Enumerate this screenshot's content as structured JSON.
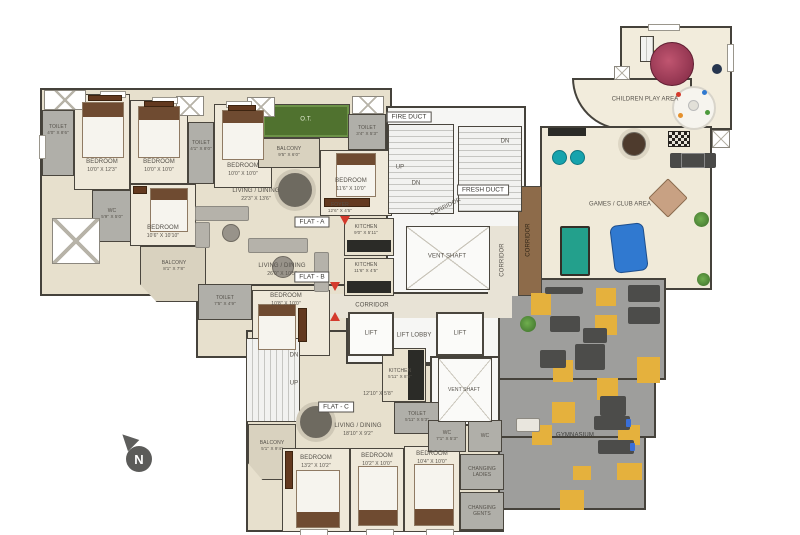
{
  "plan_title": "Residential Floor Plan with Club Amenities",
  "compass": "N",
  "colors": {
    "floor_beige": "#e7e0cd",
    "bedroom_floor": "#efe9da",
    "bath_gray": "#b0afa9",
    "gym_floor": "#9e9e9c",
    "mat_yellow": "#e5b13d",
    "terrace_green": "#50722f",
    "pool_teal": "#23a08c",
    "airhockey_blue": "#3079d0",
    "entry_red": "#d43a2c",
    "wall_dark": "#45423b",
    "wood_corridor": "#8d6b4a"
  },
  "flat_a": {
    "tag": "FLAT - A",
    "toilet1": {
      "name": "TOILET",
      "dims": "4'0\" X 8'6\""
    },
    "bedroom1": {
      "name": "BEDROOM",
      "dims": "10'0\" X 12'3\""
    },
    "bedroom2": {
      "name": "BEDROOM",
      "dims": "10'0\" X 10'0\""
    },
    "toilet2": {
      "name": "TOILET",
      "dims": "4'1\" X 8'0\""
    },
    "bedroom3": {
      "name": "BEDROOM",
      "dims": "10'0\" X 10'0\""
    },
    "living": {
      "name": "LIVING / DINING",
      "dims": "22'3\" X 13'6\""
    },
    "wc": {
      "name": "WC",
      "dims": "5'9\" X 5'0\""
    },
    "terrace": {
      "name": "O.T."
    },
    "balcony": {
      "name": "BALCONY",
      "dims": "9'5\" X 6'0\""
    },
    "toilet3": {
      "name": "TOILET",
      "dims": "3'4\" X 5'3\""
    },
    "bedroom4": {
      "name": "BEDROOM",
      "dims": "11'6\" X 10'0\""
    },
    "foyer": {
      "name": "FOYER",
      "dims": "12'6\" X 4'5\""
    },
    "kitchen": {
      "name": "KITCHEN",
      "dims": "9'0\" X 5'11\""
    }
  },
  "flat_b": {
    "tag": "FLAT - B",
    "bedroom1": {
      "name": "BEDROOM",
      "dims": "10'6\" X 10'10\""
    },
    "balcony": {
      "name": "BALCONY",
      "dims": "8'1\" X 7'8\""
    },
    "living": {
      "name": "LIVING / DINING",
      "dims": "26'0\" X 10'5\""
    },
    "kitchen": {
      "name": "KITCHEN",
      "dims": "11'6\" X 4'5\""
    },
    "toilet": {
      "name": "TOILET",
      "dims": "7'5\" X 4'9\""
    },
    "bedroom2": {
      "name": "BEDROOM",
      "dims": "10'8\" X 10'0\""
    }
  },
  "flat_c": {
    "tag": "FLAT - C",
    "living": {
      "name": "LIVING / DINING",
      "dims": "18'10\" X 9'2\""
    },
    "foyer_dims": "12'10\" X 5'8\"",
    "kitchen": {
      "name": "KITCHEN",
      "dims": "5'11\" X 8'8\""
    },
    "toilet": {
      "name": "TOILET",
      "dims": "5'11\" X 5'3\""
    },
    "balcony": {
      "name": "BALCONY",
      "dims": "5'1\" X 9'4\""
    },
    "bedroom1": {
      "name": "BEDROOM",
      "dims": "13'2\" X 10'2\""
    },
    "bedroom2": {
      "name": "BEDROOM",
      "dims": "10'2\" X 10'0\""
    },
    "bedroom3": {
      "name": "BEDROOM",
      "dims": "10'4\" X 10'0\""
    }
  },
  "core": {
    "fire_duct": "FIRE DUCT",
    "fresh_duct": "FRESH DUCT",
    "vent_shaft": "VENT SHAFT",
    "lift": "LIFT",
    "lift_lobby": "LIFT LOBBY",
    "corridor": "CORRIDOR",
    "up": "UP",
    "dn": "DN"
  },
  "amenities": {
    "children_play": "CHILDREN PLAY AREA",
    "games_club": "GAMES / CLUB AREA",
    "gymnasium": "GYMNASIUM",
    "wc1": {
      "name": "WC",
      "dims": "7'1\" X 5'3\""
    },
    "wc2": {
      "name": "WC"
    },
    "changing_ladies": "CHANGING LADIES",
    "changing_gents": "CHANGING GENTS"
  }
}
